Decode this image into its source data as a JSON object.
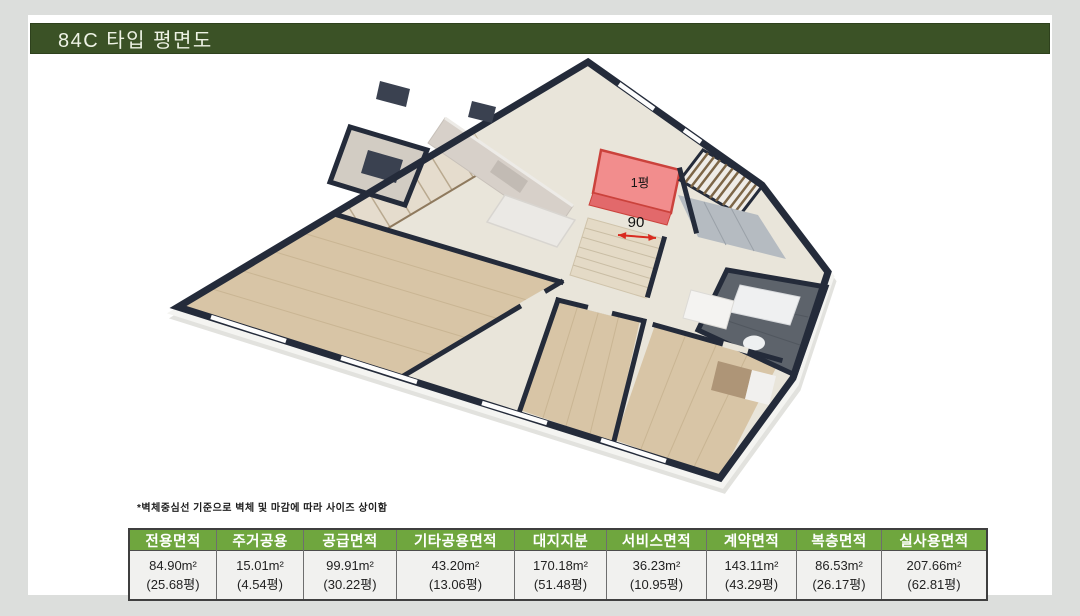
{
  "title": "84C 타입 평면도",
  "plan": {
    "area_label": "1평",
    "dim_label": "90",
    "colors": {
      "wall": "#242b3a",
      "floor": "#e9e5da",
      "wood": "#d8c5a6",
      "highlight_red": "#f28d8d",
      "arrow_red": "#d92b20",
      "title_green": "#3b5226",
      "header_green": "#6fa63e"
    }
  },
  "footnote": "*벽체중심선 기준으로 벽체 및 마감에 따라 사이즈 상이함",
  "table": {
    "cols": [
      {
        "h": "전용면적",
        "v1": "84.90m²",
        "v2": "(25.68평)"
      },
      {
        "h": "주거공용",
        "v1": "15.01m²",
        "v2": "(4.54평)"
      },
      {
        "h": "공급면적",
        "v1": "99.91m²",
        "v2": "(30.22평)"
      },
      {
        "h": "기타공용면적",
        "v1": "43.20m²",
        "v2": "(13.06평)"
      },
      {
        "h": "대지지분",
        "v1": "170.18m²",
        "v2": "(51.48평)"
      },
      {
        "h": "서비스면적",
        "v1": "36.23m²",
        "v2": "(10.95평)"
      },
      {
        "h": "계약면적",
        "v1": "143.11m²",
        "v2": "(43.29평)"
      },
      {
        "h": "복층면적",
        "v1": "86.53m²",
        "v2": "(26.17평)"
      },
      {
        "h": "실사용면적",
        "v1": "207.66m²",
        "v2": "(62.81평)"
      }
    ]
  }
}
